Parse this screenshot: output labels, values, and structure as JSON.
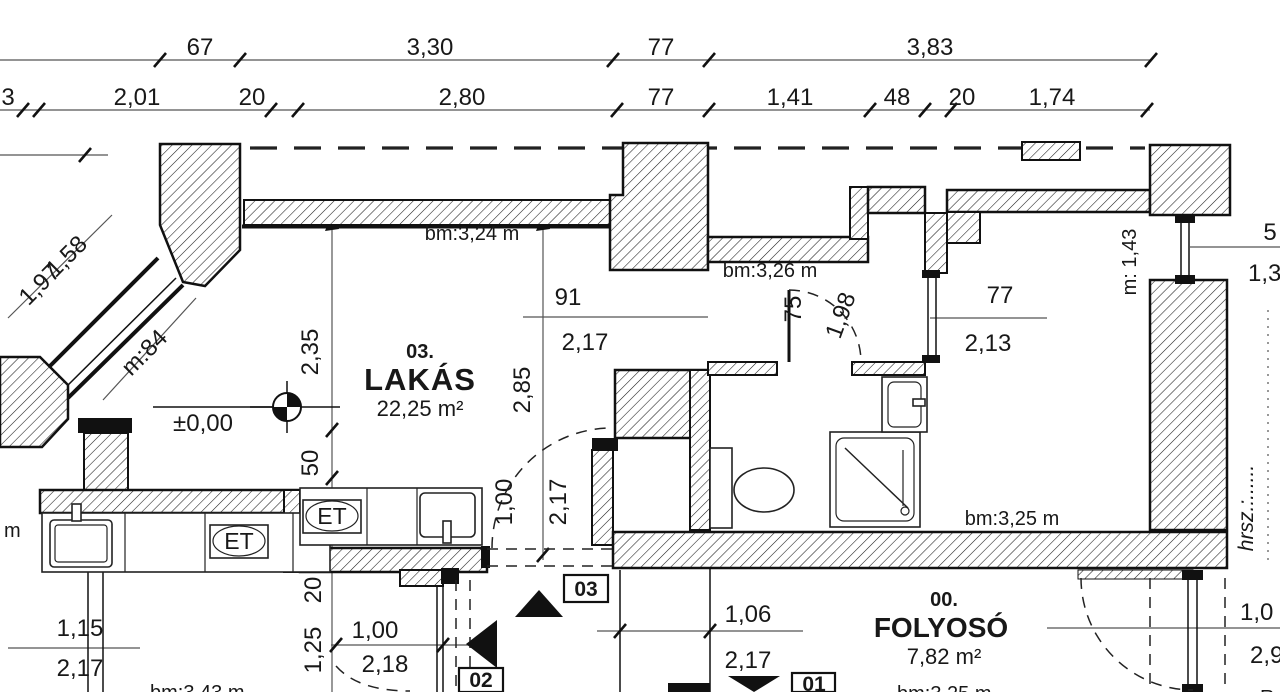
{
  "dims": {
    "top": [
      "67",
      "3,30",
      "77",
      "3,83"
    ],
    "sub": [
      "3",
      "2,01",
      "20",
      "2,80",
      "77",
      "1,41",
      "48",
      "20",
      "1,74"
    ]
  },
  "rooms": {
    "lakas": {
      "number": "03.",
      "name": "LAKÁS",
      "area": "22,25 m²"
    },
    "folyoso": {
      "number": "00.",
      "name": "FOLYOSÓ",
      "area": "7,82 m²"
    }
  },
  "heights": {
    "lakas": "bm:3,24 m",
    "hall": "bm:3,26 m",
    "room_right": "bm:3,25 m",
    "clip_left": "bm:3,43 m",
    "clip_folyoso": "bm:3,25 m"
  },
  "levels": {
    "main": "±0,00"
  },
  "markers": {
    "m01": "01",
    "m02": "02",
    "m03": "03"
  },
  "labels": {
    "et1": "ET",
    "et2": "ET",
    "hrsz": "hrsz.:......",
    "m_left": "m",
    "r_clip": "R"
  },
  "measures": {
    "diag_a": "1,58",
    "diag_b": "1,97",
    "diag_h": "m:84",
    "v235": "2,35",
    "v50": "50",
    "v285": "2,85",
    "open91_w": "91",
    "open91_h": "2,17",
    "door_lakas_w": "1,00",
    "door_lakas_h": "2,17",
    "door_bath_w": "75",
    "door_bath_sw": "1,98",
    "win77_w": "77",
    "win77_h": "2,13",
    "m143": "m: 1,43",
    "r5": "5",
    "r13": "1,3",
    "k115": "1,15",
    "k217": "2,17",
    "b20": "20",
    "b125": "1,25",
    "b100": "1,00",
    "b218": "2,18",
    "c106": "1,06",
    "c217": "2,17",
    "r10": "1,0",
    "r29": "2,9"
  },
  "colors": {
    "ink": "#181818",
    "wall_outline": "#111111",
    "dimline": "#555555"
  }
}
